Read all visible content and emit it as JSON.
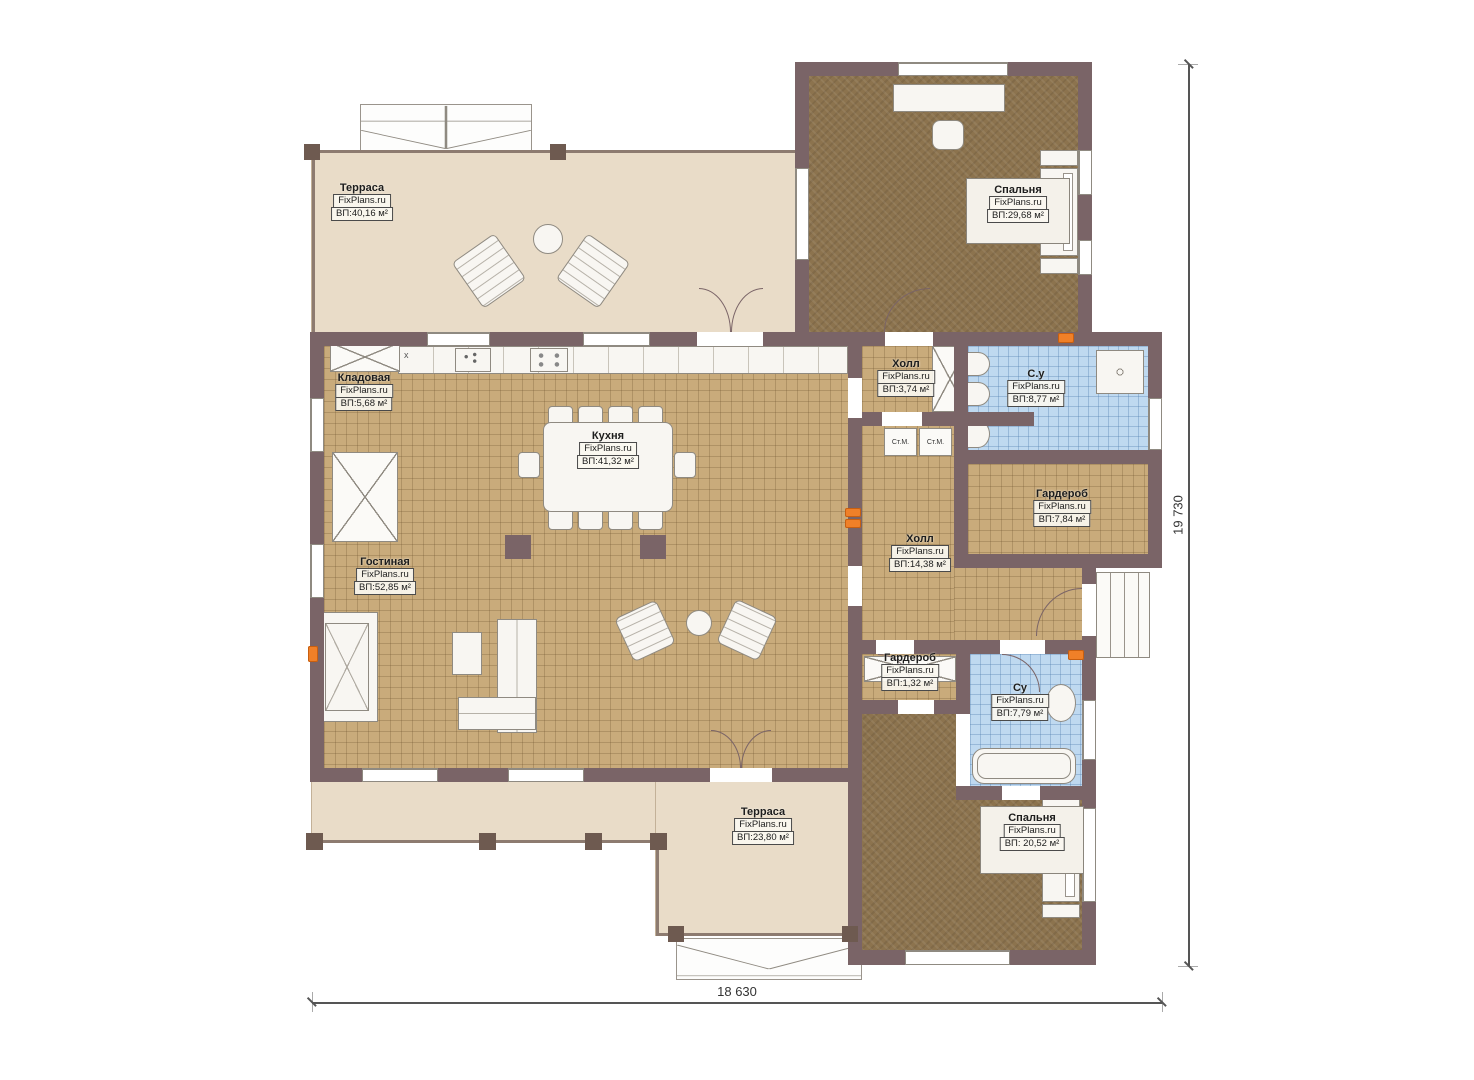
{
  "brand": "FixPlans.ru",
  "rooms": {
    "terrace_top": {
      "name": "Терраса",
      "brand": "FixPlans.ru",
      "area": "ВП:40,16 м²"
    },
    "bedroom_top": {
      "name": "Спальня",
      "brand": "FixPlans.ru",
      "area": "ВП:29,68 м²"
    },
    "storage": {
      "name": "Кладовая",
      "brand": "FixPlans.ru",
      "area": "ВП:5,68 м²"
    },
    "kitchen": {
      "name": "Кухня",
      "brand": "FixPlans.ru",
      "area": "ВП:41,32 м²"
    },
    "hall_top": {
      "name": "Холл",
      "brand": "FixPlans.ru",
      "area": "ВП:3,74 м²"
    },
    "bath_top": {
      "name": "С.у",
      "brand": "FixPlans.ru",
      "area": "ВП:8,77 м²"
    },
    "wardrobe_top": {
      "name": "Гардероб",
      "brand": "FixPlans.ru",
      "area": "ВП:7,84 м²"
    },
    "hall_main": {
      "name": "Холл",
      "brand": "FixPlans.ru",
      "area": "ВП:14,38 м²"
    },
    "living": {
      "name": "Гостиная",
      "brand": "FixPlans.ru",
      "area": "ВП:52,85 м²"
    },
    "wardrobe_small": {
      "name": "Гардероб",
      "brand": "FixPlans.ru",
      "area": "ВП:1,32 м²"
    },
    "bath_bottom": {
      "name": "Су",
      "brand": "FixPlans.ru",
      "area": "ВП:7,79 м²"
    },
    "bedroom_bottom": {
      "name": "Спальня",
      "brand": "FixPlans.ru",
      "area": "ВП: 20,52 м²"
    },
    "terrace_bottom": {
      "name": "Терраса",
      "brand": "FixPlans.ru",
      "area": "ВП:23,80 м²"
    }
  },
  "appliances": {
    "washer_left": "Ст.М.",
    "washer_right": "Ст.М."
  },
  "misc": {
    "counter_mark": "x"
  },
  "dimensions": {
    "width": "18 630",
    "height": "19 730"
  },
  "colors": {
    "wall": "#7a6467",
    "tile": "#c9ab7b",
    "carpet": "#8c734e",
    "bath": "#bfd9f0",
    "terrace": "#e9dcc8",
    "heater": "#f08028"
  }
}
